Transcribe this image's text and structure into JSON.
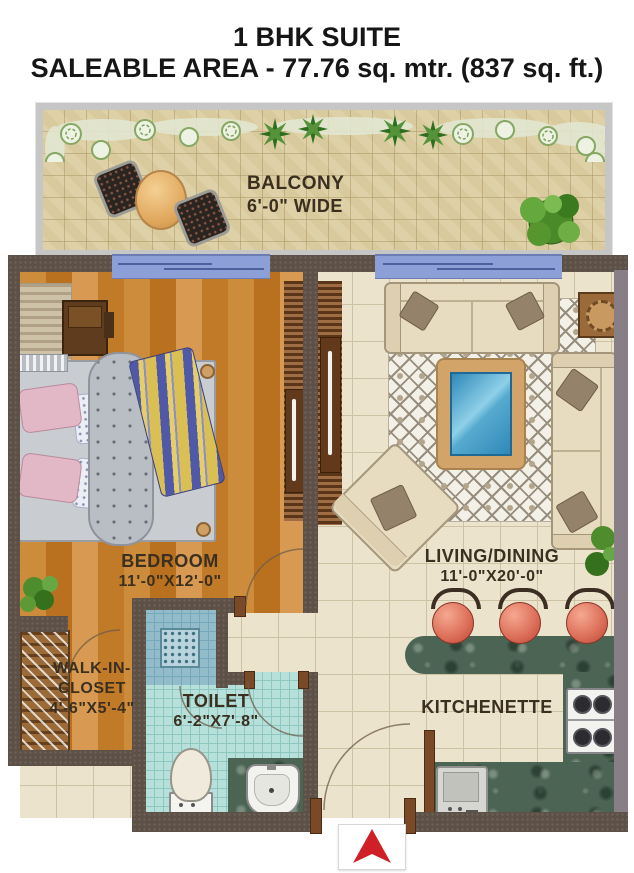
{
  "title": {
    "line1": "1 BHK SUITE",
    "line2": "SALEABLE AREA - 77.76 sq. mtr. (837 sq. ft.)"
  },
  "rooms": {
    "balcony": {
      "label": "BALCONY",
      "dimensions": "6'-0\" WIDE"
    },
    "bedroom": {
      "label": "BEDROOM",
      "dimensions": "11'-0\"X12'-0\""
    },
    "living_dining": {
      "label": "LIVING/DINING",
      "dimensions": "11'-0\"X20'-0\""
    },
    "walk_in_closet": {
      "label_line1": "WALK-IN-",
      "label_line2": "CLOSET",
      "dimensions": "4'-6\"X5'-4\""
    },
    "toilet": {
      "label": "TOILET",
      "dimensions": "6'-2\"X7'-8\""
    },
    "kitchenette": {
      "label": "KITCHENETTE"
    }
  },
  "colors": {
    "wall": "#5d5046",
    "wall_right": "#877e86",
    "balcony_wall": "#c6c6c6",
    "wood_floor": "#c5812f",
    "tile_floor": "#ebe3cc",
    "balcony_floor": "#ddcfa2",
    "toilet_floor": "#b7e0da",
    "shower_floor": "#93bccb",
    "counter_marble": "#4c6454",
    "sliding_door": "#8d9fd7",
    "entrance_arrow": "#cf2027",
    "label_text": "#3b2f20"
  }
}
